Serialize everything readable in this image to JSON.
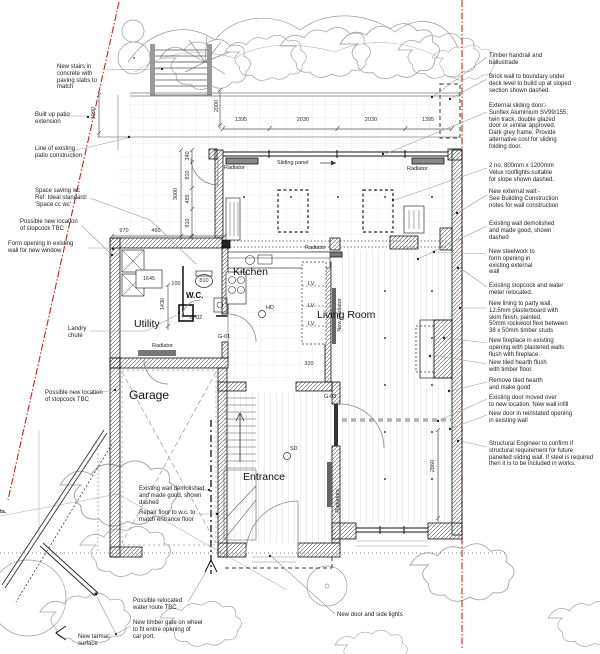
{
  "plan": {
    "rooms": {
      "kitchen": "Kitchen",
      "utility": "Utility",
      "wc": "W.C.",
      "garage": "Garage",
      "entrance": "Entrance",
      "living": "Living Room"
    },
    "fixtures": {
      "radiator": "Radiator",
      "new_radiator": "New Radiator",
      "radiators": "Radiators",
      "sliding_panel": "Sliding panel"
    },
    "doors": {
      "g01": "G-01",
      "g02": "G-02",
      "g03": "G-03"
    },
    "devices": {
      "hd": "HD",
      "sd": "SD",
      "lv": "LV"
    },
    "dims": {
      "top": [
        "1395",
        "2030",
        "2030",
        "1395"
      ],
      "v2000": "2000",
      "v1090": "1090",
      "v3000": "3000",
      "v340": "340",
      "v810": "810",
      "v485": "485",
      "v910": "910",
      "h970": "970",
      "h460": "460",
      "u1645": "1645",
      "u100": "100",
      "wc810": "810",
      "v1430": "1430",
      "k320": "320",
      "lr2860": "2860"
    },
    "colors": {
      "boundary": "#c0281c",
      "wall": "#111111",
      "leader": "#999999",
      "grid": "#d8d8d8"
    }
  },
  "annotations": {
    "left": [
      {
        "id": "new-stairs",
        "text": "New stairs in\nconcrete with\npaving slabs to\nmatch"
      },
      {
        "id": "built-up-patio",
        "text": "Built up patio\nextension"
      },
      {
        "id": "line-existing-patio",
        "text": "Line of existing\npatio construction"
      },
      {
        "id": "space-saving-wc",
        "text": "Space saving wc\nRef: Ideal standard:\n'Space cc wc'"
      },
      {
        "id": "stopcock-1",
        "text": "Possible new location\nof stopcock TBC"
      },
      {
        "id": "form-opening",
        "text": "Form opening in existing\nwall for new window"
      },
      {
        "id": "landry-chute",
        "text": "Landry\nchute"
      },
      {
        "id": "stopcock-2",
        "text": "Possible new location\nof stopcock TBC"
      }
    ],
    "right": [
      {
        "id": "timber-handrail",
        "text": "Timber handrail and\nballustrade"
      },
      {
        "id": "brick-wall",
        "text": "Brick wall to boundary under\ndeck level to build up at sloped\nsection shown dashed."
      },
      {
        "id": "external-sliding-door",
        "text": "External sliding door:-\nSunflex Aluminium SV99/155,\ntwin track, double glazed\ndoor or similar approved.\nDark grey frame.  Provide\nalternative cost for sliding\nfolding door."
      },
      {
        "id": "velux",
        "text": "2 no. 800mm x 1200mm\nVelux rooflights suitable\nfor slope shown dashed."
      },
      {
        "id": "new-external-wall",
        "text": "New external wall:-\nSee Building Construction\nnotes for wall construction"
      },
      {
        "id": "existing-wall-demolished",
        "text": "Existing wall demolished\nand made good, shown\ndashed"
      },
      {
        "id": "steelwork",
        "text": "New steelwork to\nform opening in\nexisting external\nwall"
      },
      {
        "id": "stopcock-relocated",
        "text": "Existing stopcock and water\nmeter relocated."
      },
      {
        "id": "party-wall",
        "text": "New lining to party wall,\n12.5mm plasterboard with\nskim finish, painted.\n50mm rockwool flexi between\n38 x 50mm timber studs"
      },
      {
        "id": "fireplace",
        "text": "New fireplace in existing\nopening with plastered walls\nflush with fireplace."
      },
      {
        "id": "hearth",
        "text": "New tiled hearth flush\nwith timber floor."
      },
      {
        "id": "remove-hearth",
        "text": "Remove tiled hearth\nand make good"
      },
      {
        "id": "door-moved",
        "text": "Existing door moved over\nto new location.  New wall infill"
      },
      {
        "id": "door-reinstated",
        "text": "New door in reinstated opening\nin existing wall"
      },
      {
        "id": "structural-engineer",
        "text": "Structural Engineer to confirm if\nstructural requirement for future\npanelled sliding wall.  If steel is required\nthen it is to be included in works."
      }
    ],
    "bottom": [
      {
        "id": "water-route",
        "text": "Possible relocated\nwater route TBC"
      },
      {
        "id": "timber-gate",
        "text": "New timber gate on wheel\nto fit entire opening of\ncar port."
      },
      {
        "id": "tarmac",
        "text": "New tarmac\nsurface"
      },
      {
        "id": "door-side-lights",
        "text": "New door and side lights"
      }
    ],
    "plan": [
      {
        "id": "garage-wall-demolished",
        "text": "Existing wall demolished\nand made good, shown\ndashed"
      },
      {
        "id": "repair-floor",
        "text": "Repair floor to w.c. to\nmatch entrance floor"
      },
      {
        "id": "edge-fragment",
        "text": "ts."
      }
    ]
  }
}
